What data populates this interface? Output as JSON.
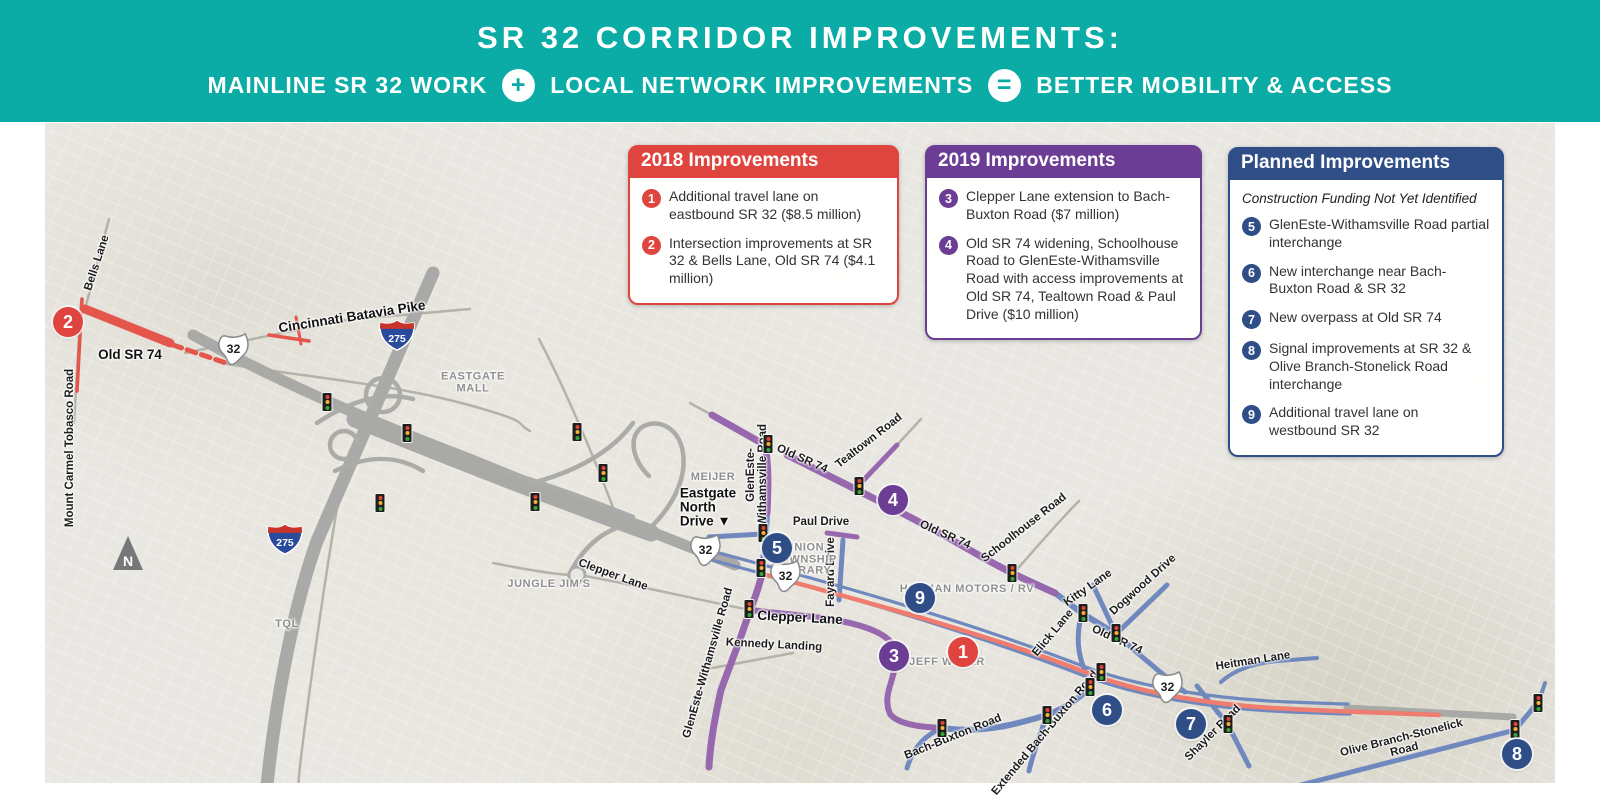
{
  "colors": {
    "teal": "#0aaca5",
    "red": "#df453e",
    "purple": "#6b3d94",
    "blue": "#2f4e87",
    "roadPurple": "#9768ae",
    "roadBlue": "#6f88be",
    "roadRed": "#ef7c6e",
    "highlightRed": "#e4564c"
  },
  "header": {
    "title": "SR 32 CORRIDOR IMPROVEMENTS:",
    "equation": {
      "term1": "MAINLINE SR 32 WORK",
      "operator1": "+",
      "term2": "LOCAL NETWORK IMPROVEMENTS",
      "operator2": "=",
      "term3": "BETTER MOBILITY & ACCESS"
    }
  },
  "boxes": [
    {
      "id": "2018",
      "theme": "red",
      "title": "2018 Improvements",
      "items": [
        {
          "num": "1",
          "text": "Additional travel lane on eastbound SR 32 ($8.5 million)"
        },
        {
          "num": "2",
          "text": "Intersection improvements at SR 32 & Bells Lane, Old SR 74 ($4.1 million)"
        }
      ]
    },
    {
      "id": "2019",
      "theme": "purple",
      "title": "2019 Improvements",
      "items": [
        {
          "num": "3",
          "text": "Clepper Lane extension to Bach-Buxton Road ($7 million)"
        },
        {
          "num": "4",
          "text": "Old SR 74 widening, Schoolhouse Road to GlenEste-Withamsville Road with access improvements at Old SR 74, Tealtown Road & Paul Drive ($10 million)"
        }
      ]
    },
    {
      "id": "planned",
      "theme": "blue",
      "title": "Planned Improvements",
      "subtitle": "Construction Funding Not Yet Identified",
      "items": [
        {
          "num": "5",
          "text": "GlenEste-Withamsville Road partial interchange"
        },
        {
          "num": "6",
          "text": "New interchange near Bach-Buxton Road & SR 32"
        },
        {
          "num": "7",
          "text": "New overpass at Old SR 74"
        },
        {
          "num": "8",
          "text": "Signal improvements at SR 32 & Olive Branch-Stonelick Road interchange"
        },
        {
          "num": "9",
          "text": "Additional travel lane on westbound SR 32"
        }
      ]
    }
  ],
  "map": {
    "north_label": "N",
    "shields": {
      "sr32_label": "32",
      "i275_label": "275",
      "sr32": [
        [
          188,
          229
        ],
        [
          660,
          430
        ],
        [
          740,
          456
        ],
        [
          1122,
          567
        ]
      ],
      "i275": [
        [
          352,
          215
        ],
        [
          240,
          419
        ]
      ]
    },
    "markers": [
      {
        "label": "2",
        "color": "red",
        "x": 23,
        "y": 199
      },
      {
        "label": "5",
        "color": "blue",
        "x": 732,
        "y": 425
      },
      {
        "label": "4",
        "color": "purple",
        "x": 848,
        "y": 377
      },
      {
        "label": "9",
        "color": "blue",
        "x": 875,
        "y": 475
      },
      {
        "label": "3",
        "color": "purple",
        "x": 849,
        "y": 533
      },
      {
        "label": "1",
        "color": "red",
        "x": 918,
        "y": 529
      },
      {
        "label": "6",
        "color": "blue",
        "x": 1062,
        "y": 587
      },
      {
        "label": "7",
        "color": "blue",
        "x": 1146,
        "y": 601
      },
      {
        "label": "8",
        "color": "blue",
        "x": 1472,
        "y": 631
      }
    ],
    "labels": [
      {
        "text": "Bells Lane",
        "x": 52,
        "y": 140,
        "rot": -72,
        "kind": "road"
      },
      {
        "text": "Old SR 74",
        "x": 85,
        "y": 232,
        "rot": 0,
        "kind": "road-big"
      },
      {
        "text": "Mount Carmel Tobasco Road",
        "x": 25,
        "y": 325,
        "rot": -90,
        "kind": "road"
      },
      {
        "text": "Cincinnati Batavia Pike",
        "x": 307,
        "y": 194,
        "rot": -9,
        "kind": "road-big"
      },
      {
        "text": "EASTGATE\nMALL",
        "x": 428,
        "y": 260,
        "rot": 0,
        "kind": "poi"
      },
      {
        "text": "MEIJER",
        "x": 668,
        "y": 355,
        "rot": 0,
        "kind": "poi"
      },
      {
        "text": "Eastgate\nNorth\nDrive ▼",
        "x": 663,
        "y": 385,
        "rot": 0,
        "kind": "road-big",
        "align": "left"
      },
      {
        "text": "GlenEste-\nWithamsville Road",
        "x": 712,
        "y": 352,
        "rot": -90,
        "kind": "road"
      },
      {
        "text": "Old SR 74",
        "x": 757,
        "y": 336,
        "rot": 24,
        "kind": "road"
      },
      {
        "text": "Tealtown Road",
        "x": 824,
        "y": 318,
        "rot": -38,
        "kind": "road"
      },
      {
        "text": "Paul Drive",
        "x": 776,
        "y": 399,
        "rot": 0,
        "kind": "road"
      },
      {
        "text": "Fayard Drive",
        "x": 786,
        "y": 449,
        "rot": -90,
        "kind": "road"
      },
      {
        "text": "UNION\nTOWNSHIP\nLIBRARY",
        "x": 760,
        "y": 437,
        "rot": 0,
        "kind": "poi"
      },
      {
        "text": "JUNGLE JIM'S",
        "x": 504,
        "y": 462,
        "rot": 0,
        "kind": "poi"
      },
      {
        "text": "TQL",
        "x": 242,
        "y": 502,
        "rot": 0,
        "kind": "poi"
      },
      {
        "text": "Clepper Lane",
        "x": 568,
        "y": 452,
        "rot": 20,
        "kind": "road"
      },
      {
        "text": "Clepper Lane",
        "x": 755,
        "y": 495,
        "rot": 3,
        "kind": "road-big"
      },
      {
        "text": "Kennedy Landing",
        "x": 729,
        "y": 522,
        "rot": 3,
        "kind": "road"
      },
      {
        "text": "GlenEste-Withamsville Road",
        "x": 663,
        "y": 540,
        "rot": -74,
        "kind": "road"
      },
      {
        "text": "HOLMAN MOTORS / RV",
        "x": 922,
        "y": 467,
        "rot": 0,
        "kind": "poi"
      },
      {
        "text": "JEFF WYLER",
        "x": 902,
        "y": 540,
        "rot": 0,
        "kind": "poi"
      },
      {
        "text": "Schoolhouse Road",
        "x": 979,
        "y": 405,
        "rot": -38,
        "kind": "road"
      },
      {
        "text": "Old SR 74",
        "x": 900,
        "y": 412,
        "rot": 24,
        "kind": "road"
      },
      {
        "text": "Elick Lane",
        "x": 1008,
        "y": 510,
        "rot": -50,
        "kind": "road"
      },
      {
        "text": "Kitty Lane",
        "x": 1043,
        "y": 465,
        "rot": -35,
        "kind": "road"
      },
      {
        "text": "Dogwood Drive",
        "x": 1098,
        "y": 462,
        "rot": -42,
        "kind": "road"
      },
      {
        "text": "Old SR 74",
        "x": 1072,
        "y": 517,
        "rot": 25,
        "kind": "road"
      },
      {
        "text": "Bach-Buxton Road",
        "x": 908,
        "y": 614,
        "rot": -22,
        "kind": "road"
      },
      {
        "text": "Extended Bach-Buxton Road",
        "x": 1000,
        "y": 610,
        "rot": -50,
        "kind": "road"
      },
      {
        "text": "Heitman Lane",
        "x": 1208,
        "y": 538,
        "rot": -9,
        "kind": "road"
      },
      {
        "text": "Shayler Road",
        "x": 1168,
        "y": 610,
        "rot": -45,
        "kind": "road"
      },
      {
        "text": "Olive Branch-Stonelick Road",
        "x": 1358,
        "y": 621,
        "rot": -14,
        "kind": "road"
      }
    ],
    "traffic_lights": [
      [
        282,
        279
      ],
      [
        362,
        310
      ],
      [
        335,
        380
      ],
      [
        532,
        309
      ],
      [
        558,
        350
      ],
      [
        490,
        379
      ],
      [
        723,
        321
      ],
      [
        718,
        410
      ],
      [
        716,
        445
      ],
      [
        704,
        486
      ],
      [
        814,
        363
      ],
      [
        967,
        450
      ],
      [
        1038,
        490
      ],
      [
        1071,
        510
      ],
      [
        1056,
        549
      ],
      [
        1045,
        564
      ],
      [
        1002,
        592
      ],
      [
        897,
        605
      ],
      [
        1183,
        601
      ],
      [
        1470,
        606
      ],
      [
        1493,
        580
      ]
    ]
  }
}
